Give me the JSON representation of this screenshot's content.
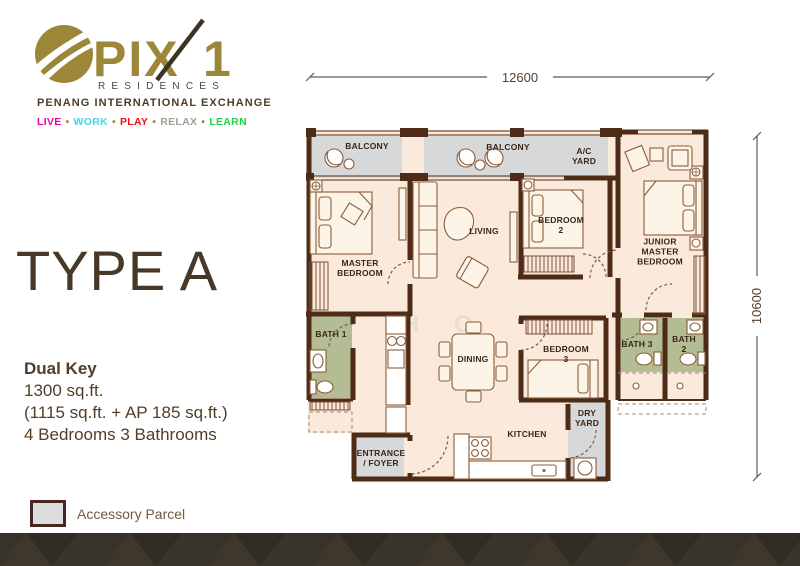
{
  "brand": {
    "pix": "PIX",
    "one": "1",
    "residences": "RESIDENCES",
    "subtitle": "PENANG INTERNATIONAL EXCHANGE",
    "tagline": {
      "live": "LIVE",
      "work": "WORK",
      "play": "PLAY",
      "relax": "RELAX",
      "learn": "LEARN",
      "sep": "•"
    }
  },
  "type_panel": {
    "title": "TYPE A",
    "key_type": "Dual Key",
    "area_total": "1300 sq.ft.",
    "area_breakdown": "(1115 sq.ft. + AP 185 sq.ft.)",
    "rooms_summary": "4 Bedrooms 3 Bathrooms"
  },
  "floorplan": {
    "dim_width": "12600",
    "dim_height": "10600",
    "watermark": "H O",
    "rooms": {
      "balcony_left": "BALCONY",
      "balcony_mid": "BALCONY",
      "ac_yard": "A/C\nYARD",
      "master_bedroom": "MASTER\nBEDROOM",
      "living": "LIVING",
      "bedroom_2": "BEDROOM\n2",
      "junior_master": "JUNIOR\nMASTER\nBEDROOM",
      "bath_1": "BATH 1",
      "dining": "DINING",
      "bedroom_3": "BEDROOM\n3",
      "bath_3": "BATH 3",
      "bath_2": "BATH 2",
      "dry_yard": "DRY\nYARD",
      "kitchen": "KITCHEN",
      "entrance": "ENTRANCE\n/ FOYER"
    }
  },
  "legend": {
    "accessory_parcel": "Accessory Parcel"
  },
  "colors": {
    "brand_gold": "#9c8637",
    "wall_brown": "#4e2b16",
    "floor_cream": "#fbeadc",
    "accessory_gray": "#d7d8da",
    "bath_green": "#b3bc92",
    "band_brown": "#37322a",
    "text_brown": "#473828",
    "tagline_live": "#ea00a8",
    "tagline_work": "#45d4f0",
    "tagline_play": "#ee1111",
    "tagline_relax": "#a39d94",
    "tagline_learn": "#1fd24f"
  }
}
